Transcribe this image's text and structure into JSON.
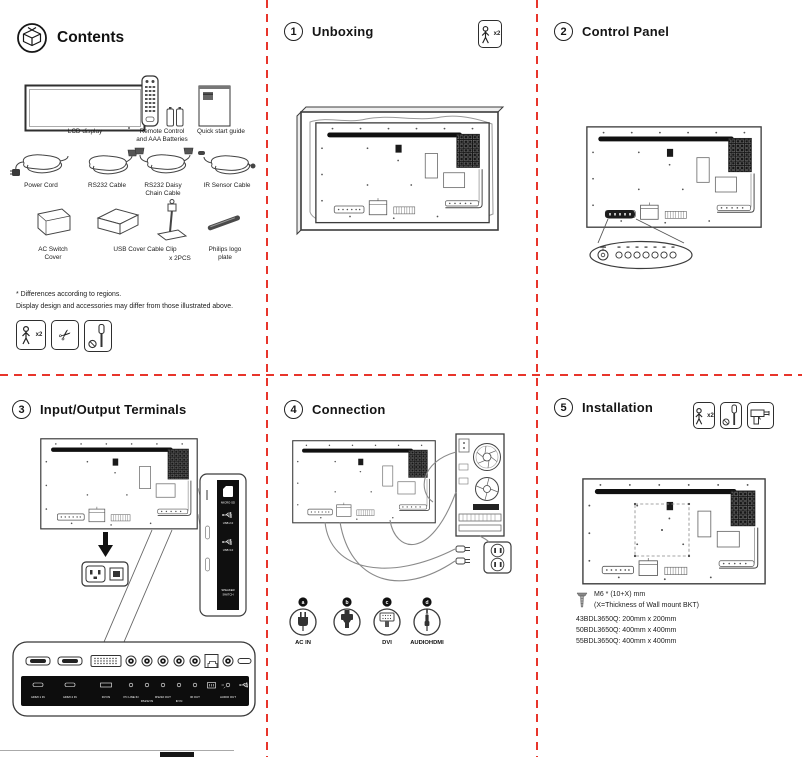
{
  "page": {
    "divider_color": "#e8352b"
  },
  "contents": {
    "title": "Contents",
    "row1": [
      {
        "label": "LCD display"
      },
      {
        "label": "Remote Control\nand AAA Batteries"
      },
      {
        "label": "Quick start guide"
      }
    ],
    "row2": [
      {
        "label": "Power Cord"
      },
      {
        "label": "RS232 Cable"
      },
      {
        "label": "RS232 Daisy\nChain Cable"
      },
      {
        "label": "IR Sensor Cable"
      }
    ],
    "row3": [
      {
        "label": "AC Switch\nCover"
      },
      {
        "label": "USB Cover Cable Clip"
      },
      {
        "label": "x 2PCS"
      },
      {
        "label": "Philips logo\nplate"
      }
    ],
    "note1": "* Differences according to regions.",
    "note2": "Display design and accessories may differ from those illustrated above.",
    "people_badge": "x2"
  },
  "unboxing": {
    "number": "1",
    "title": "Unboxing",
    "people_badge": "x2"
  },
  "control_panel": {
    "number": "2",
    "title": "Control Panel"
  },
  "io": {
    "number": "3",
    "title": "Input/Output Terminals",
    "side_ports": [
      "MICRO SD",
      "USB 2.0",
      "USB 3.0",
      "SPEAKER",
      "SWITCH"
    ],
    "ports": [
      "HDMI 1 IN",
      "HDMI 2 IN",
      "DVI IN",
      "PC LINE IN",
      "RS232 IN",
      "RS232 OUT",
      "IR IN",
      "IR OUT",
      "AUDIO OUT"
    ]
  },
  "connection": {
    "number": "4",
    "title": "Connection",
    "connectors": [
      {
        "key": "a",
        "label": "AC IN"
      },
      {
        "key": "b",
        "label": ""
      },
      {
        "key": "c",
        "label": "DVI"
      },
      {
        "key": "d",
        "label": "AUDIOHDMI"
      }
    ]
  },
  "installation": {
    "number": "5",
    "title": "Installation",
    "people_badge": "x2",
    "screw_line1": "M6 * (10+X) mm",
    "screw_line2": "(X=Thickness of Wall mount BKT)",
    "models": [
      "43BDL3650Q: 200mm x 200mm",
      "50BDL3650Q: 400mm x 400mm",
      "55BDL3650Q: 400mm x 400mm"
    ]
  }
}
